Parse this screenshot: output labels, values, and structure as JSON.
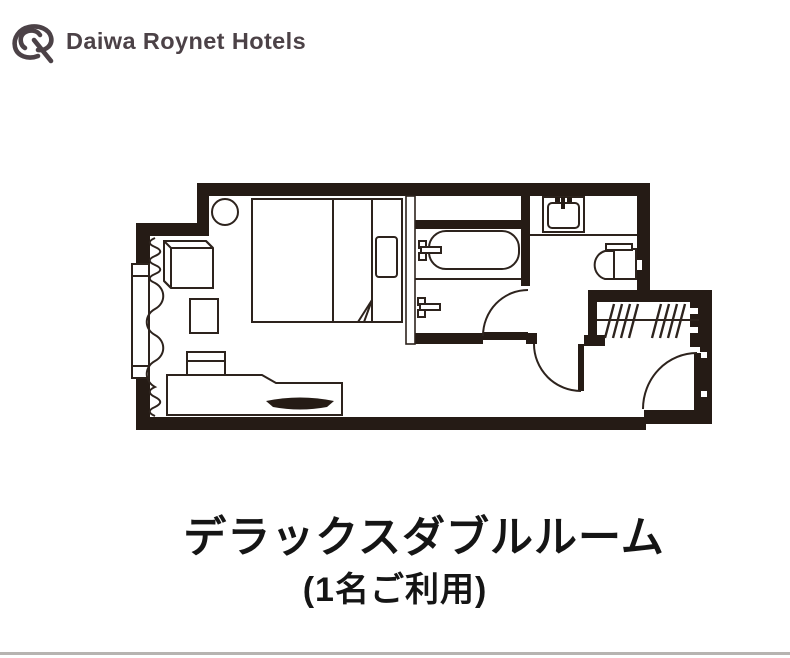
{
  "brand": {
    "name": "Daiwa Roynet Hotels",
    "logo_icon": "daiwa-roynet-monogram",
    "logo_color": "#4c4247"
  },
  "caption": {
    "title": "デラックスダブルルーム",
    "subtitle": "(1名ご利用)"
  },
  "floorplan": {
    "wall_color": "#251b15",
    "line_color": "#2d231d",
    "fixtures": [
      "window",
      "curtain",
      "round-table",
      "armchair",
      "side-table",
      "double-bed",
      "pillow",
      "bed-fold",
      "amenity-box",
      "desk",
      "tv",
      "bath-upper-shelf",
      "bathtub",
      "bath-faucet",
      "shower-faucet",
      "washbasin",
      "toilet",
      "closet-rod",
      "hangers",
      "bathroom-door",
      "hall-door",
      "entrance-door"
    ]
  },
  "page": {
    "background": "#ffffff",
    "bottom_rule_color": "#b7b4b1"
  }
}
